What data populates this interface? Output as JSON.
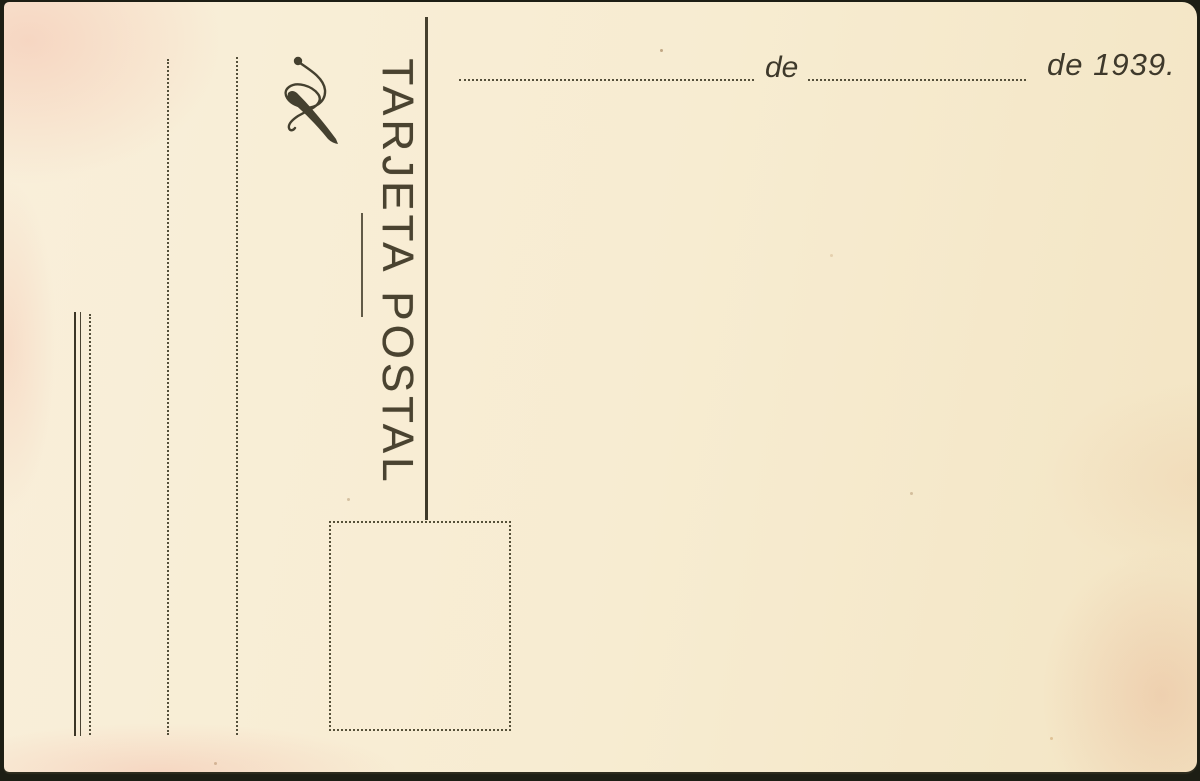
{
  "postcard": {
    "title": "TARJETA POSTAL",
    "date_line": {
      "de_label": "de",
      "year_label": "de 1939."
    },
    "icons": {
      "flourish": "calligraphic-flourish-icon"
    },
    "colors": {
      "paper": "#f7ecd1",
      "ink": "#4a4330",
      "edge": "#1d1e14",
      "blush": "#f2ae9c",
      "stain": "#e09270"
    }
  }
}
